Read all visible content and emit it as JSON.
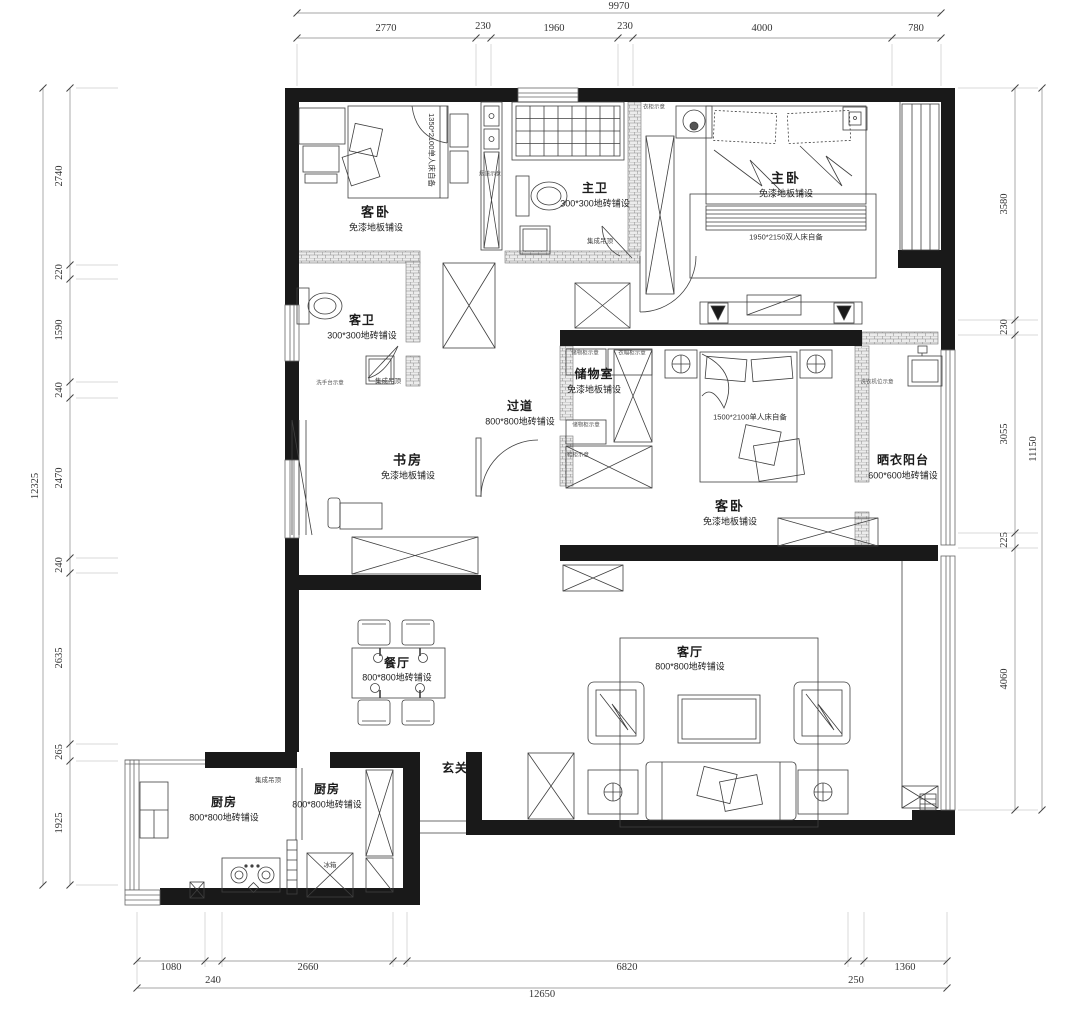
{
  "dims": {
    "top": {
      "total": "9970",
      "segments": [
        "2770",
        "230",
        "1960",
        "230",
        "4000",
        "780"
      ]
    },
    "left": {
      "total": "12325",
      "segments": [
        "2740",
        "220",
        "1590",
        "240",
        "2470",
        "240",
        "2635",
        "265",
        "1925"
      ]
    },
    "right": {
      "total": "11150",
      "segments": [
        "3580",
        "230",
        "3055",
        "225",
        "4060"
      ]
    },
    "bottom": {
      "total": "12650",
      "segments": [
        "1080",
        "240",
        "2660",
        "6820",
        "250",
        "1360"
      ]
    }
  },
  "rooms": [
    {
      "name": "客卧",
      "spec": "免漆地板铺设"
    },
    {
      "name": "主卫",
      "spec": "300*300地砖铺设"
    },
    {
      "name": "主卧",
      "spec": "免漆地板铺设"
    },
    {
      "name": "客卫",
      "spec": "300*300地砖铺设"
    },
    {
      "name": "储物室",
      "spec": "免漆地板铺设"
    },
    {
      "name": "过道",
      "spec": "800*800地砖铺设"
    },
    {
      "name": "书房",
      "spec": "免漆地板铺设"
    },
    {
      "name": "客卧",
      "spec": "免漆地板铺设"
    },
    {
      "name": "晒衣阳台",
      "spec": "600*600地砖铺设"
    },
    {
      "name": "餐厅",
      "spec": "800*800地砖铺设"
    },
    {
      "name": "客厅",
      "spec": "800*800地砖铺设"
    },
    {
      "name": "玄关",
      "spec": ""
    },
    {
      "name": "厨房",
      "spec": "800*800地砖铺设"
    },
    {
      "name": "厨房",
      "spec": "800*800地砖铺设"
    }
  ],
  "annotations": {
    "ceiling": "集成吊顶",
    "fridge": "冰箱",
    "washer": "洗衣机位示意",
    "shaft": "烟道示意",
    "vanity": "洗手台示意",
    "wardrobe": "衣柜示意",
    "storage_cabinet": "储物柜示意",
    "coat_cabinet": "衣帽柜示意",
    "shoe_cabinet": "鞋柜示意",
    "bed_master": "1950*2150双人床自备",
    "bed_guest": "1500*2100单人床自备",
    "bed_guest_small": "1350*2100单人床自备"
  }
}
